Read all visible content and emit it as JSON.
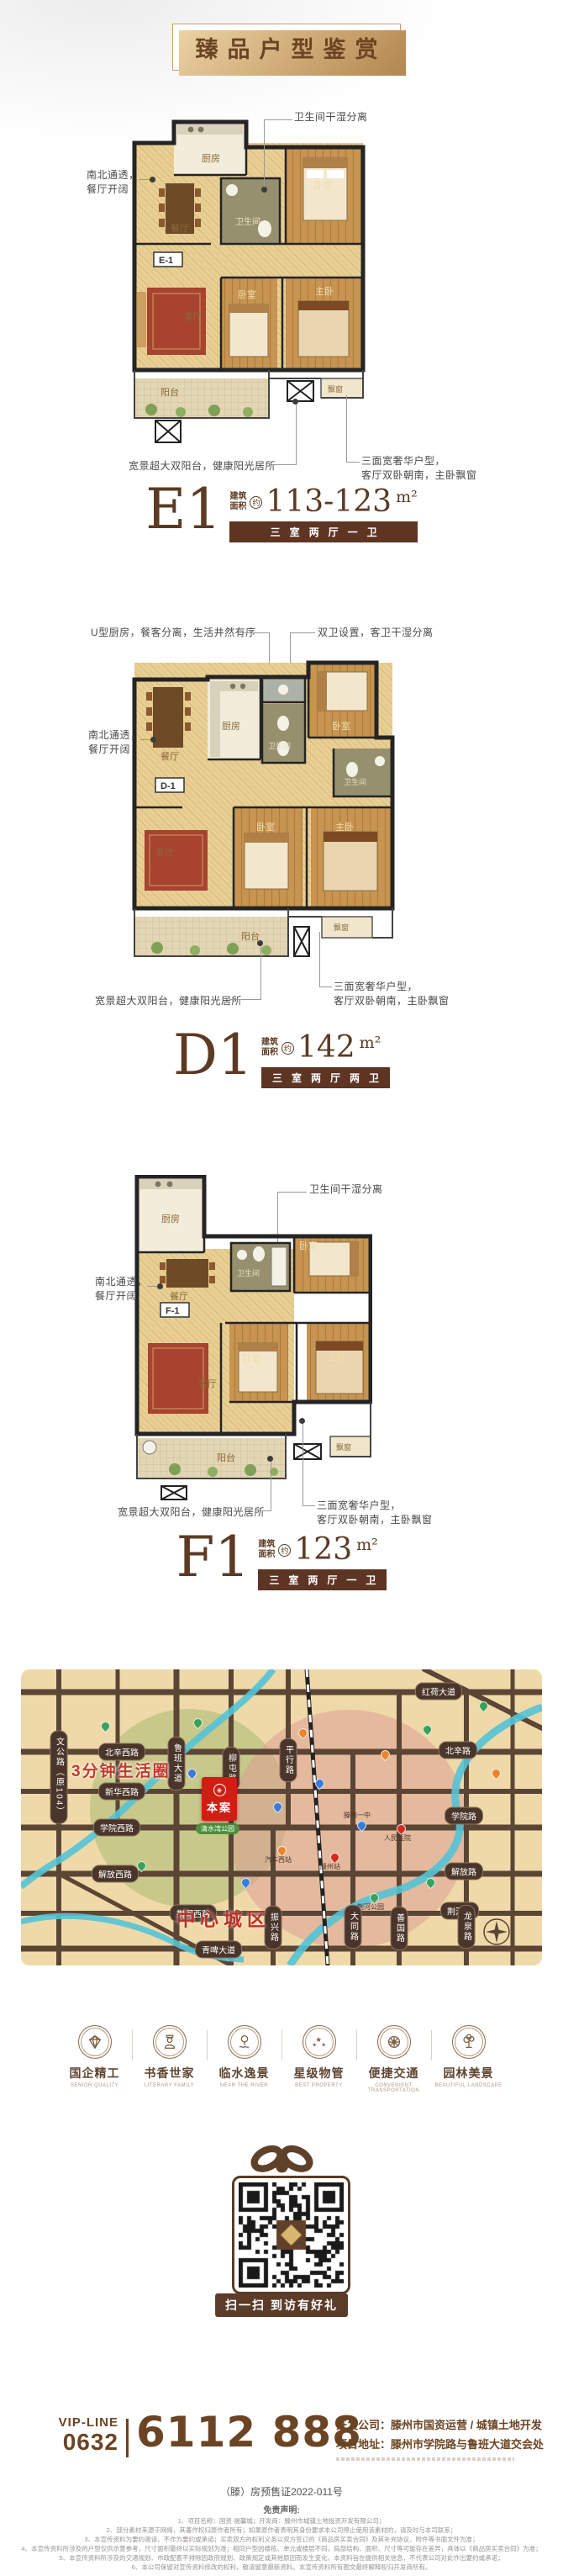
{
  "banner": {
    "title": "臻品户型鉴赏"
  },
  "plans": [
    {
      "name": "E1",
      "code": "E-1",
      "area_label": "建筑\n面积",
      "approx": "约",
      "area_value": "113-123",
      "area_unit": "m²",
      "spec": "三室两厅一卫",
      "rooms": {
        "kitchen": "厨房",
        "bath": "卫生间",
        "bedroom_top": "卧室",
        "dining": "餐厅",
        "living": "客厅",
        "bedroom_mid": "卧室",
        "master": "主卧",
        "balcony": "阳台",
        "bay": "飘窗"
      },
      "notes": {
        "top_right": "卫生间干湿分离",
        "left": "南北通透，\n餐厅开阔",
        "bottom_left": "宽景超大双阳台，健康阳光居所",
        "bottom_right": "三面宽奢华户型，\n客厅双卧朝南，主卧飘窗"
      }
    },
    {
      "name": "D1",
      "code": "D-1",
      "area_label": "建筑\n面积",
      "approx": "约",
      "area_value": "142",
      "area_unit": "m²",
      "spec": "三室两厅两卫",
      "rooms": {
        "dining": "餐厅",
        "kitchen": "厨房",
        "bath_guest": "卫生间",
        "bedroom_top": "卧室",
        "bath_master": "卫生间",
        "living": "客厅",
        "bedroom_mid": "卧室",
        "master": "主卧",
        "balcony": "阳台",
        "bay": "飘窗"
      },
      "notes": {
        "top_left": "U型厨房，餐客分离，生活井然有序",
        "top_right": "双卫设置，客卫干湿分离",
        "left": "南北通透，\n餐厅开阔",
        "bottom_left": "宽景超大双阳台，健康阳光居所",
        "bottom_right": "三面宽奢华户型，\n客厅双卧朝南，主卧飘窗"
      }
    },
    {
      "name": "F1",
      "code": "F-1",
      "area_label": "建筑\n面积",
      "approx": "约",
      "area_value": "123",
      "area_unit": "m²",
      "spec": "三室两厅一卫",
      "rooms": {
        "kitchen": "厨房",
        "bath": "卫生间",
        "bedroom_top": "卧室",
        "dining": "餐厅",
        "living": "客厅",
        "bedroom_mid": "卧室",
        "master": "主卧",
        "balcony": "阳台",
        "bay": "飘窗"
      },
      "notes": {
        "top_right": "卫生间干湿分离",
        "left": "南北通透，\n餐厅开阔",
        "bottom_left": "宽景超大双阳台，健康阳光居所",
        "bottom_right": "三面宽奢华户型，\n客厅双卧朝南，主卧飘窗"
      }
    }
  ],
  "map": {
    "life_circle": "3分钟生活圈",
    "center_zone": "中心城区",
    "project": "本案",
    "park": "清水湾公园",
    "roads_h": [
      "红荷大道",
      "北辛西路",
      "北辛路",
      "新华西路",
      "学院西路",
      "学院路",
      "解放西路",
      "解放路",
      "荆河西路",
      "荆河路",
      "青啤大道"
    ],
    "roads_v": [
      "文公路（原104）",
      "鲁班大道",
      "柳屯路",
      "平行路",
      "振兴路",
      "大同路",
      "善国路",
      "龙泉路"
    ],
    "pois": [
      "汽车西站",
      "滕州站",
      "人民医院",
      "滕州一中",
      "荆河公园"
    ]
  },
  "features": [
    {
      "label": "国企精工",
      "sub": "SENIOR QUALITY"
    },
    {
      "label": "书香世家",
      "sub": "LITERARY FAMILY"
    },
    {
      "label": "临水逸景",
      "sub": "NEAR THE RIVER"
    },
    {
      "label": "星级物管",
      "sub": "BEST PROPERTY"
    },
    {
      "label": "便捷交通",
      "sub": "CONVENIENT TRANSPORTATION"
    },
    {
      "label": "园林美景",
      "sub": "BEAUTIFUL LANDSCAPE"
    }
  ],
  "qr": {
    "caption": "扫一扫 到访有好礼"
  },
  "footer": {
    "vip_line": "VIP-LINE",
    "area_code": "0632",
    "phone": "6112 888",
    "company_line": "开发公司：滕州市国资运营 / 城镇土地开发",
    "address_line": "项目地址：滕州市学院路与鲁班大道交会处",
    "permit": "（滕）房预售证2022-011号",
    "disclaimer_title": "免责声明:",
    "disclaimers": [
      "1、项目名称：国资·晟馨城；开发商：滕州市城镇土地投资开发有限公司；",
      "2、部分素材来源于网络，其著作权归原作者所有；如果原作者表明其身份要求本公司停止使用该素材的，请及时与本司联系；",
      "3、本宣传资料为要约邀请，不作为要约或承诺；买卖双方的权利义务以双方签订的《商品房买卖合同》及其补充协议、附件等书面文件为准；",
      "4、本宣传资料所涉及的户型仅供示意参考，尺寸面积最终以实际规划为准；相同户型因楼栋、单元或楼层不同，局部结构、面积、尺寸等可能存在差异，具体以《商品房买卖合同》为准；",
      "5、本宣传资料所涉及的交通规划、市政配套不排除因政府规划、政策规定或其他原因而发生变化，本资料旨在提供相关信息，不代表公司对此作出要约或承诺；",
      "6、本公司保留对宣传资料修改的权利，敬请留意最新资料。本宣传资料所有图文最终解释权归开发商所有。"
    ]
  }
}
